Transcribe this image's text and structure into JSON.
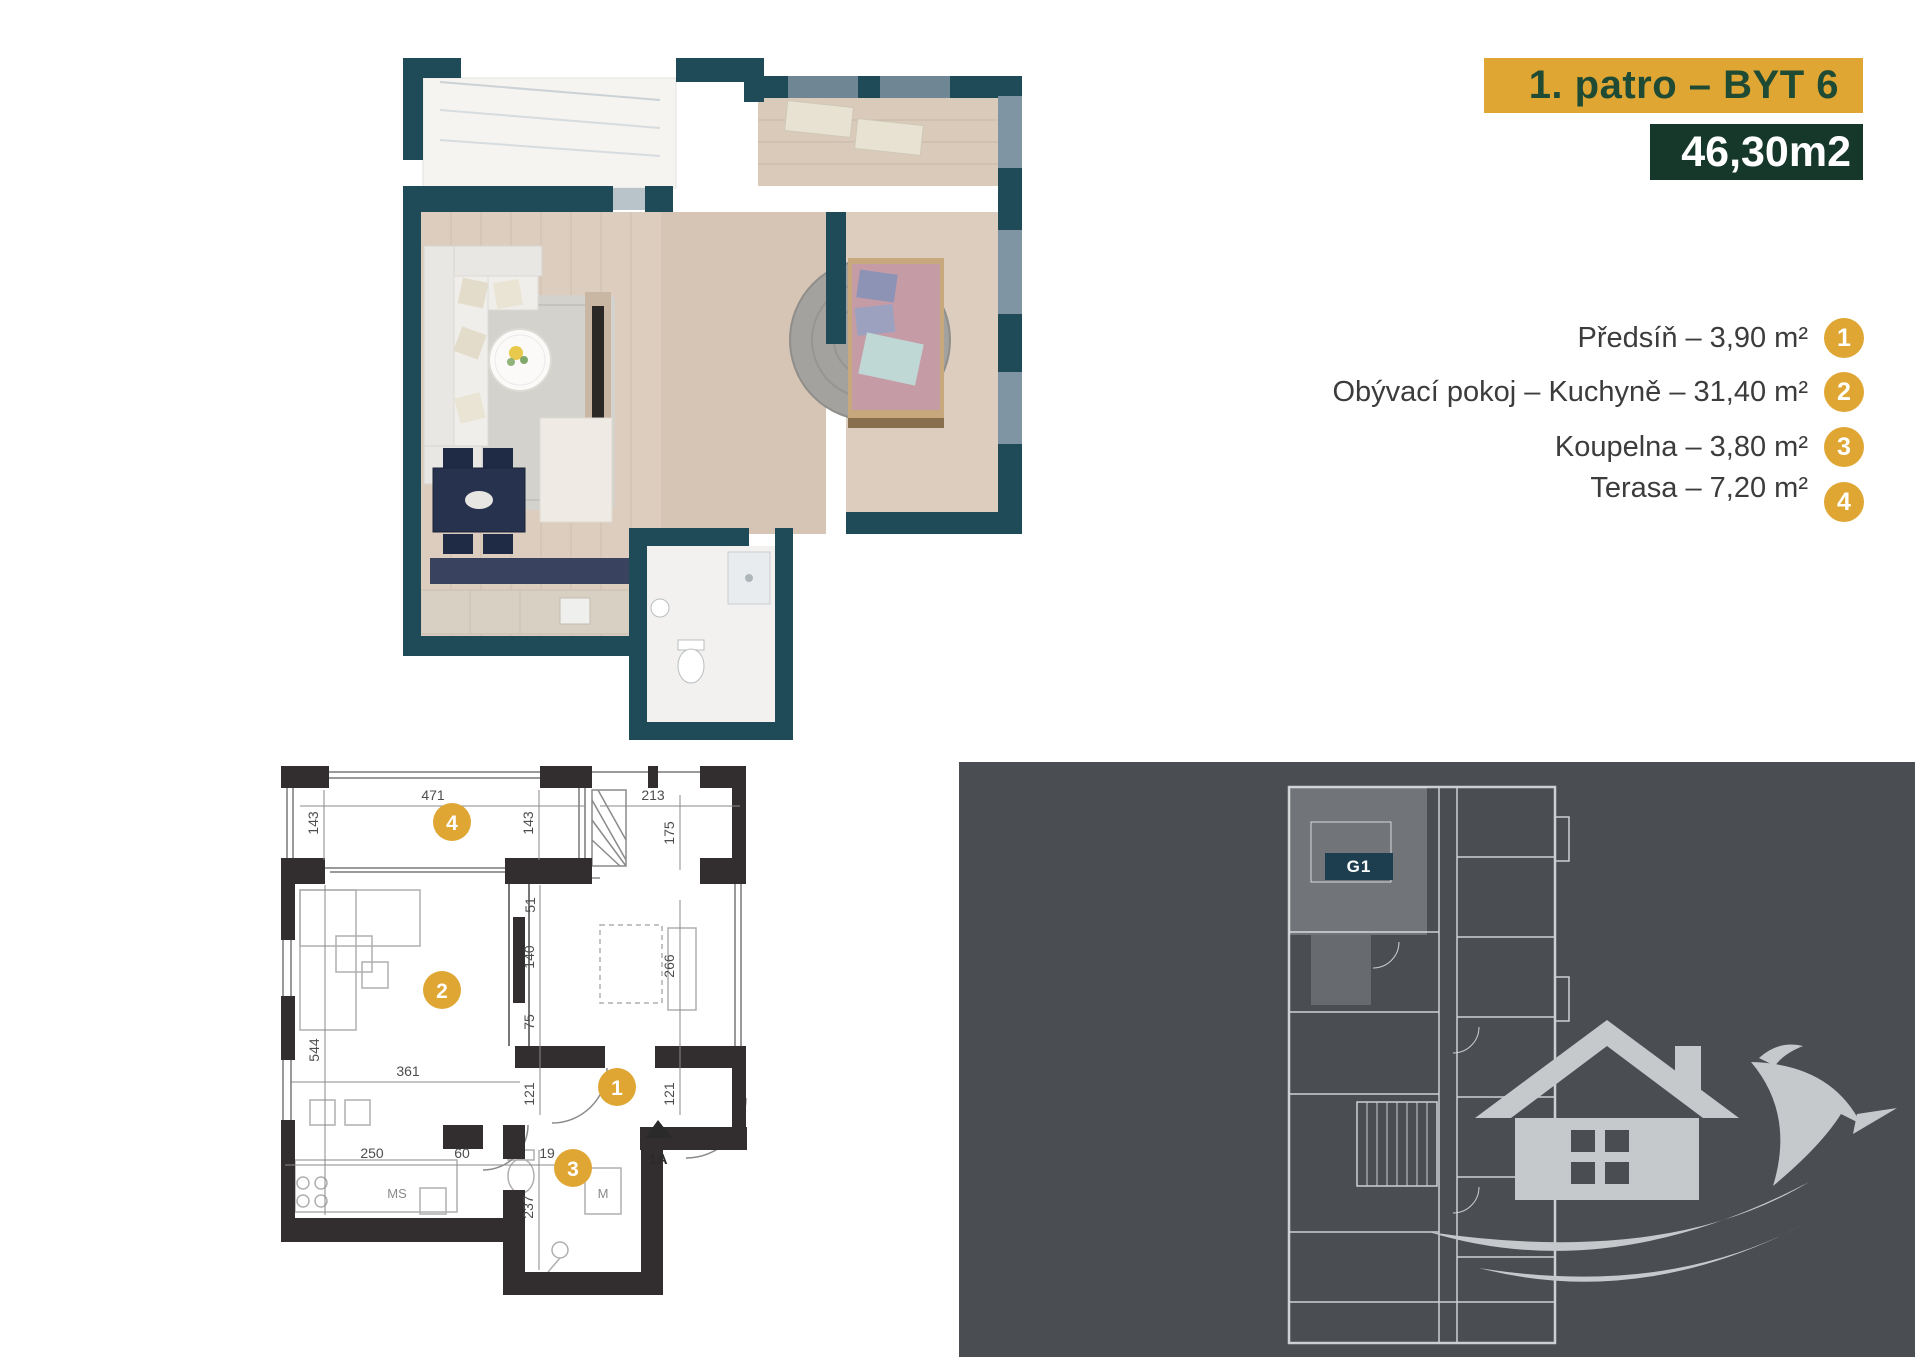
{
  "header": {
    "floor_label": "1. patro – BYT 6",
    "area_label": "46,30m2"
  },
  "legend": {
    "rows": [
      {
        "num": "1",
        "label": "Předsíň – 3,90 m²"
      },
      {
        "num": "2",
        "label": "Obývací pokoj – Kuchyně – 31,40 m²"
      },
      {
        "num": "3",
        "label": "Koupelna – 3,80 m²"
      },
      {
        "num": "4",
        "label": "Terasa – 7,20 m²"
      }
    ]
  },
  "plan2d": {
    "markers": [
      {
        "num": "4"
      },
      {
        "num": "2"
      },
      {
        "num": "1"
      },
      {
        "num": "3"
      }
    ],
    "dims": [
      "471",
      "213",
      "143",
      "143",
      "175",
      "51",
      "140",
      "75",
      "266",
      "544",
      "361",
      "121",
      "121",
      "250",
      "60",
      "19",
      "237"
    ],
    "labels": {
      "kitchen": "MS",
      "washer": "M",
      "entrance": "1A"
    }
  },
  "site_plan": {
    "unit_label": "G1"
  },
  "colors": {
    "gold": "#DFA634",
    "header_text_green": "#1F4B35",
    "area_box_green": "#16382A",
    "wall_teal_3d": "#1F4A58",
    "panel_gray": "#4A4E53",
    "plan_wall_dark": "#322E2F",
    "watermark_gray": "#C6C9CB"
  }
}
